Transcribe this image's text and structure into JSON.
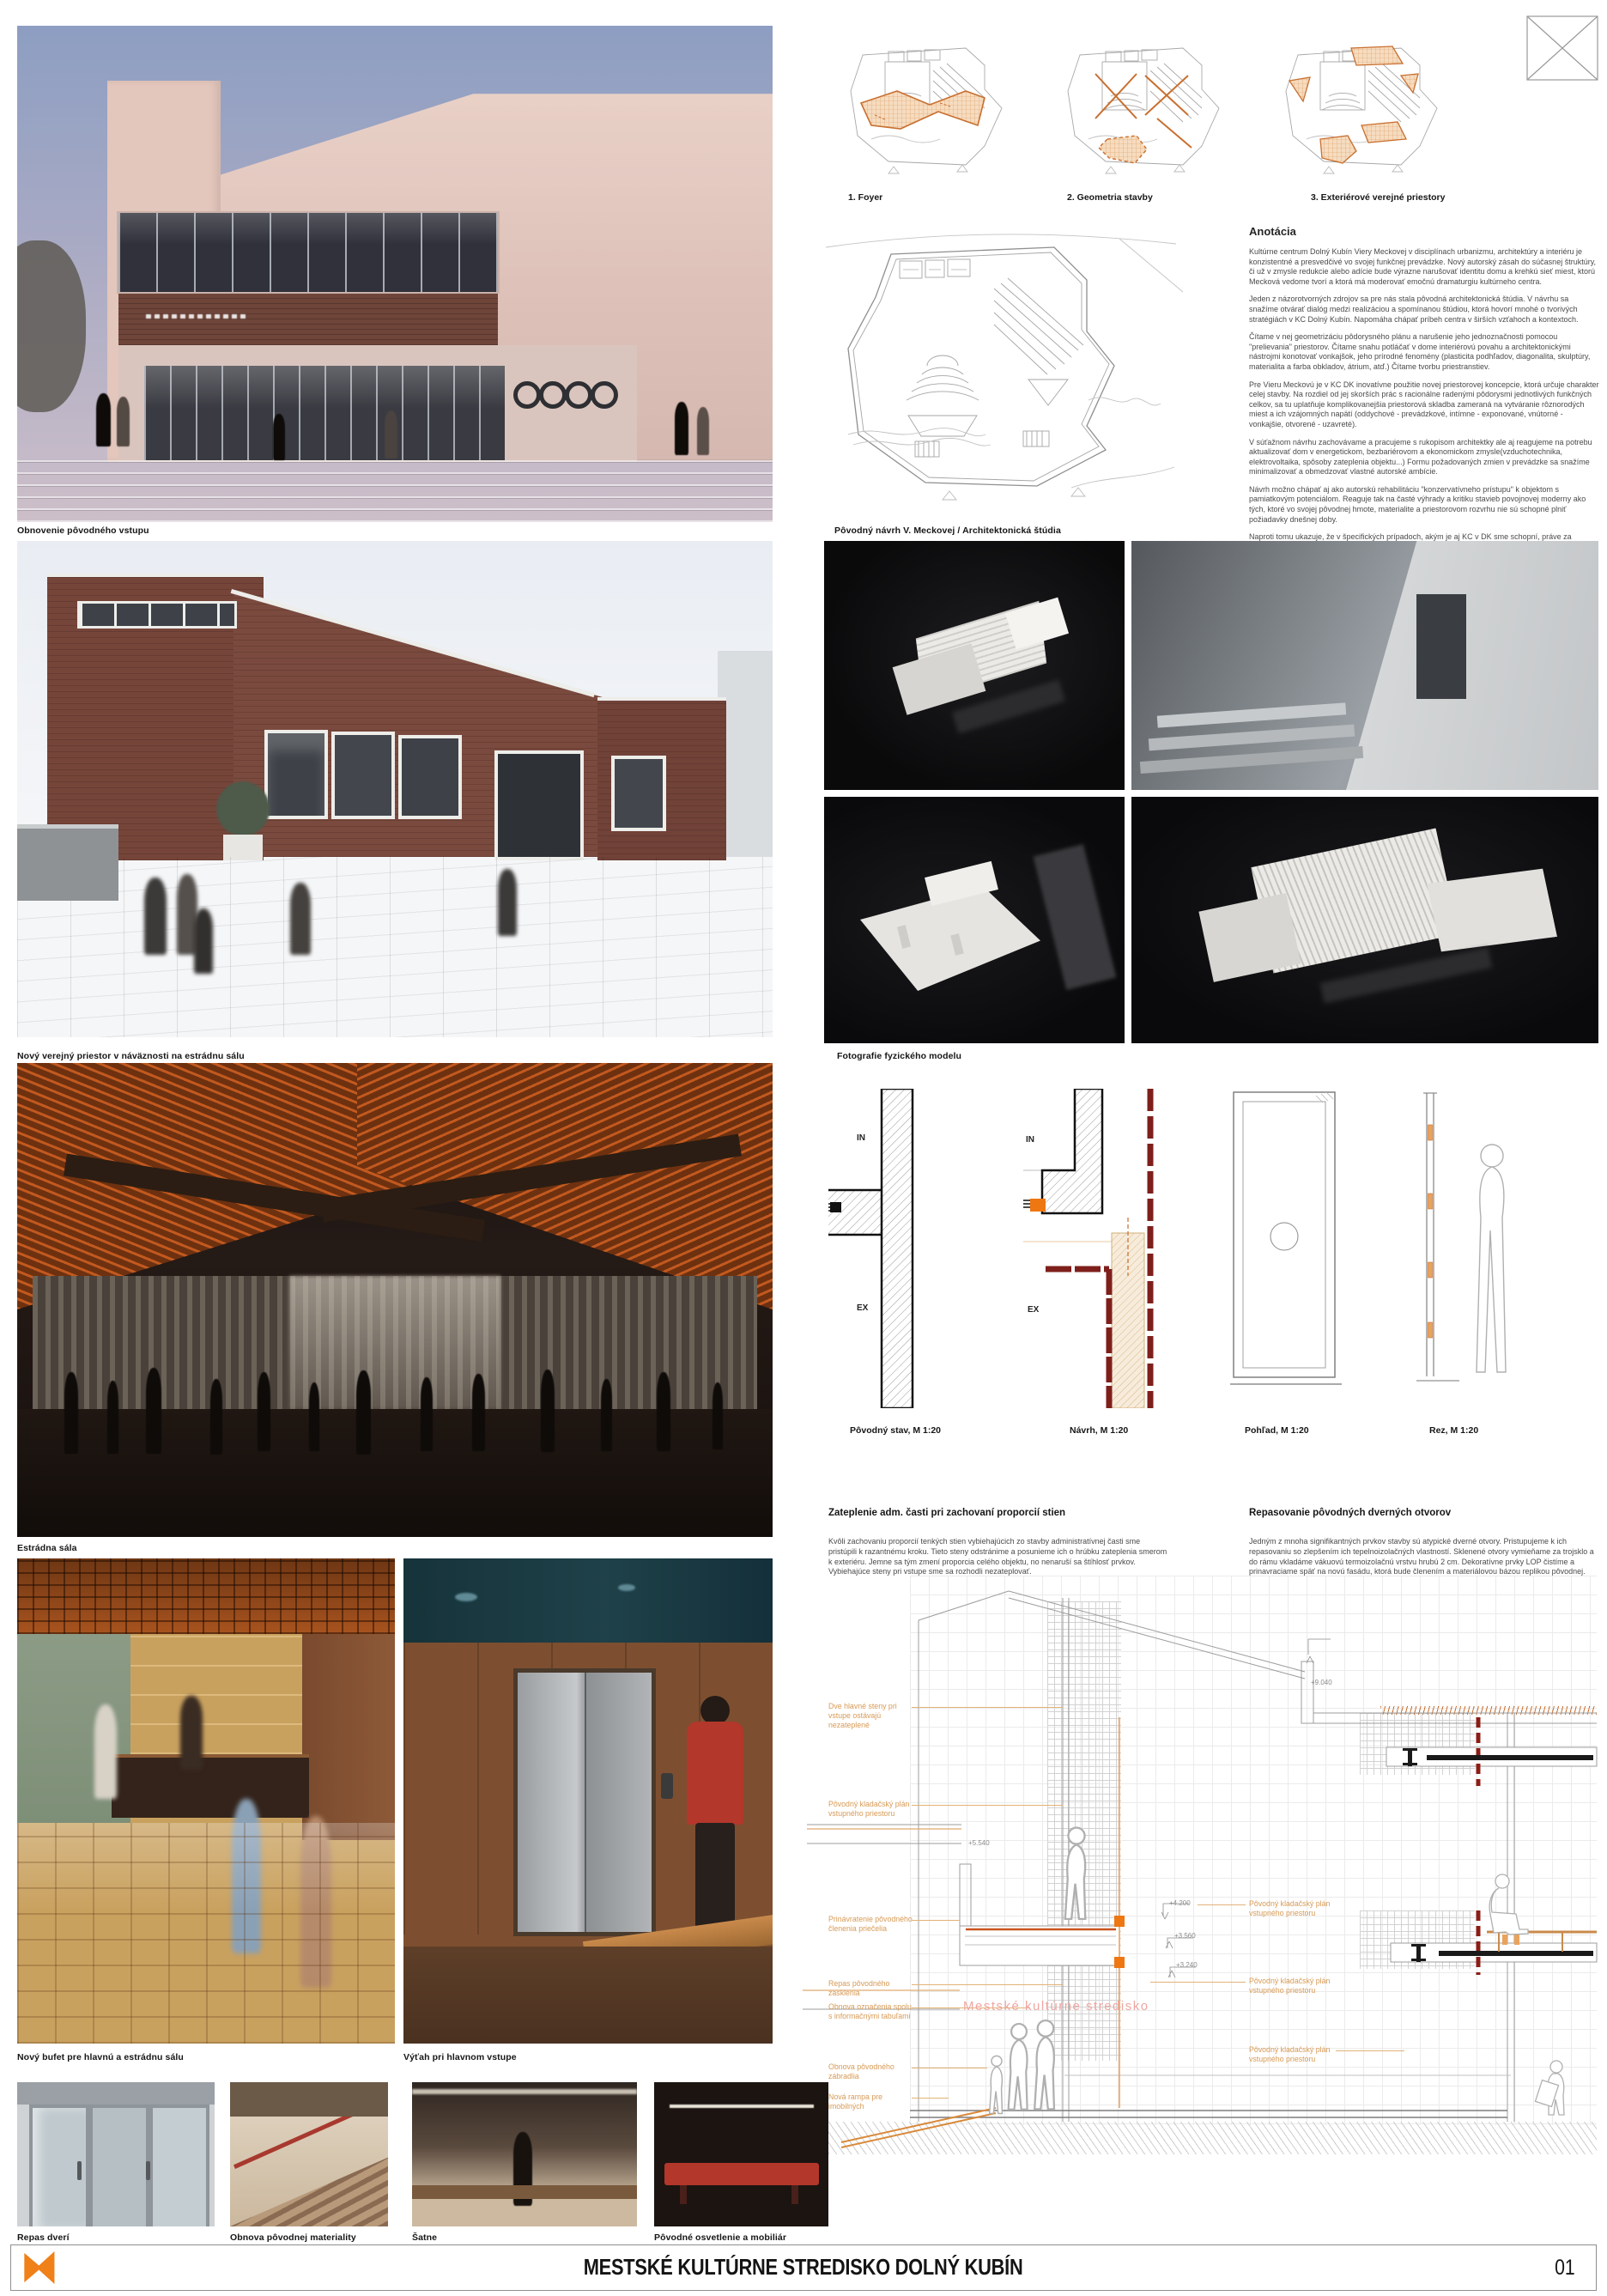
{
  "row1": {
    "photo_caption": "Obnovenie pôvodného vstupu",
    "plans": [
      "1. Foyer",
      "2. Geometria stavby",
      "3. Exteriérové verejné priestory"
    ],
    "floorplan_caption": "Pôvodný návrh V. Meckovej / Architektonická štúdia"
  },
  "annotation": {
    "title": "Anotácia",
    "paragraphs": [
      "Kultúrne centrum Dolný Kubín Viery Meckovej v disciplínach urbanizmu, architektúry a interiéru je konzistentné a presvedčivé vo svojej funkčnej prevádzke. Nový autorský zásah do súčasnej štruktúry, či už v zmysle redukcie alebo adície bude výrazne narušovať identitu domu a krehkú sieť miest, ktorú Mecková vedome tvorí a ktorá má moderovať emočnú dramaturgiu kultúrneho centra.",
      "Jeden z názorotvorných zdrojov sa pre nás stala pôvodná architektonická štúdia. V návrhu sa snažíme otvárať dialóg medzi realizáciou a spomínanou štúdiou, ktorá hovorí mnohé o tvorivých stratégiách v KC Dolný Kubín. Napomáha chápať príbeh centra v širších vzťahoch a kontextoch.",
      "Čítame v nej geometrizáciu pôdorysného plánu a narušenie jeho jednoznačnosti pomocou \"prelievania\" priestorov. Čítame snahu potláčať v dome interiérovú povahu a architektonickými nástrojmi konotovať vonkajšok, jeho prírodné fenomény (plasticita podhľadov, diagonalita, skulptúry, materialita a farba obkladov, átrium, atď.) Čítame tvorbu priestranstiev.",
      "Pre Vieru Meckovú je v KC DK inovatívne použitie novej priestorovej koncepcie, ktorá určuje charakter celej stavby. Na rozdiel od jej skorších prác s racionálne radenými pôdorysmi jednotlivých funkčných celkov, sa tu uplatňuje komplikovanejšia priestorová skladba zameraná na vytváranie rôznorodých miest a ich vzájomných napätí (oddychové - prevádzkové, intímne - exponované, vnútorné - vonkajšie, otvorené - uzavreté).",
      "V súťažnom návrhu zachovávame a pracujeme s rukopisom architektky ale aj reagujeme na potrebu aktualizovať dom v energetickom, bezbariérovom a ekonomickom zmysle(vzduchotechnika, elektrovoltaika, spôsoby zateplenia objektu...) Formu požadovaných zmien v prevádzke sa snažíme minimalizovať a obmedzovať vlastné autorské ambície.",
      "Návrh možno chápať aj ako autorskú rehabilitáciu \"konzervatívneho prístupu\" k objektom s pamiatkovým potenciálom. Reaguje tak na časté výhrady a kritiku stavieb povojnovej moderny ako tých, ktoré vo svojej pôvodnej hmote, materialite a priestorovom rozvrhu nie sú schopné plniť požiadavky dnešnej doby.",
      "Naproti tomu ukazuje, že v špecifických prípadoch, akým je aj KC v DK sme schopní, práve za použitia minimálneho počtu zásahov a zmien, zachovávať hodnotnú architektúru nielen v jej vydestilovanej \"ideovej\" modernistickej podobe, ale aj ako reálnu, fyzickú štruktúru s vlastnou historicitou.",
      "Nejde však len o \"zakonzervovanie\" bez vzťahu k súčasnosti. Rozhodnutie o zvolenom prístupe bolo učinené na základe overenia funkčných vzťahov, súčasného technického fyzického stavu objektu i preskúmania pôvodnej štúdie.",
      "I keď v čo najväčšej miere zachováva pôvodné dielo, nevzdáva sa úplne prejavu súčasného autorského gesta. To však namiesto samotnej architektúry orientuje najmä do aktualizovania bezprostredného okolia."
    ]
  },
  "row2": {
    "photo_caption": "Nový verejný priestor v náväznosti na estrádnu sálu",
    "models_caption": "Fotografie fyzického modelu"
  },
  "row3": {
    "photo_caption": "Estrádna sála",
    "detail_labels": [
      "Pôvodný stav, M 1:20",
      "Návrh, M 1:20",
      "Pohľad, M 1:20",
      "Rez, M 1:20"
    ],
    "in_label": "IN",
    "ex_label": "EX",
    "blocks": [
      {
        "title": "Zateplenie adm. časti pri zachovaní proporcií stien",
        "body": "Kvôli zachovaniu proporcií tenkých stien vybiehajúcich zo stavby administratívnej časti sme pristúpili k razantnému kroku. Tieto steny odstránime a posunieme ich o hrúbku zateplenia smerom k exteriéru. Jemne sa tým zmení proporcia celého objektu, no nenaruší sa štíhlosť prvkov. Vybiehajúce steny pri vstupe sme sa rozhodli nezateplovať."
      },
      {
        "title": "Repasovanie pôvodných dverných otvorov",
        "body": "Jedným z mnoha signifikantných prvkov stavby sú atypické dverné otvory. Pristupujeme k ich repasovaniu so zlepšením ich tepelnoizolačných vlastností. Sklenené otvory vymieňame za trojsklo a do rámu vkladáme vákuovú termoizolačnú vrstvu hrubú 2 cm. Dekoratívne prvky LOP čistíme a prinavraciame späť na novú fasádu, ktorá bude členením a materiálovou bázou replikou pôvodnej."
      }
    ]
  },
  "row4": {
    "captions": [
      "Nový bufet pre hlavnú a estrádnu sálu",
      "Výťah pri hlavnom vstupe"
    ]
  },
  "section": {
    "watermark": "Mestské kultúrne stredisko",
    "dims": [
      "+9.040",
      "+5.540",
      "+4.200",
      "+3.560",
      "+3.240"
    ],
    "left_labels": [
      "Dve hlavné steny pri vstupe ostávajú nezateplené",
      "Pôvodný kladačský plán vstupného priestoru",
      "Prinávratenie pôvodného členenia priečelia",
      "Repas pôvodného zasklenia",
      "Obnova označenia spolu s informačnými tabuľami",
      "Obnova pôvodného zábradlia",
      "Nová rampa pre imobilných"
    ],
    "right_labels": [
      "Pôvodný kladačský plán vstupného priestoru",
      "Pôvodný kladačský plán vstupného priestoru",
      "Pôvodný kladačský plán vstupného priestoru"
    ]
  },
  "row5": {
    "captions": [
      "Repas dverí",
      "Obnova pôvodnej materiality",
      "Šatne",
      "Pôvodné osvetlenie a mobiliár"
    ]
  },
  "footer": {
    "title": "MESTSKÉ KULTÚRNE STREDISKO DOLNÝ KUBÍN",
    "page_number": "01"
  },
  "colors": {
    "accent_orange": "#EE7711",
    "plan_highlight": "#F4D2AC",
    "plan_stroke": "#C96F2F",
    "brick_red": "#7E1F1B",
    "label_orange": "#D79A55",
    "watermark_pink": "#F0A6A2"
  }
}
